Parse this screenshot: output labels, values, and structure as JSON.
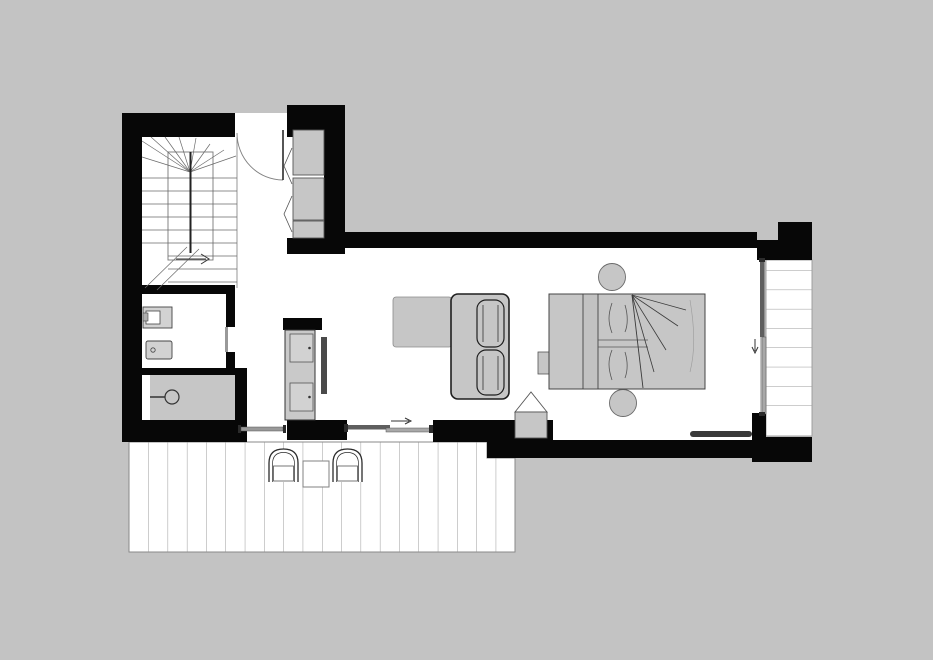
{
  "document": {
    "kind": "architectural floor plan",
    "description": "Monochrome apartment floor plan with black walls, winder staircase, bathroom, shower, kitchen unit, living area with L-shaped sofa, sleeping area with double bed, wooden deck with two chairs and side table, and a narrow side balcony",
    "visible_text": ""
  },
  "colors": {
    "bg": "#c3c3c3",
    "floor": "#ffffff",
    "wall": "#070707",
    "furn": "#c6c6c6",
    "furnlight": "#d2d2d2",
    "furndark": "#b8b8b8",
    "ink": "#2b2b2b",
    "mid": "#555555",
    "line": "#9a9a9a",
    "glass1": "#5f5f5f",
    "glass2": "#a8a8a8",
    "dark": "#3a3a3a"
  },
  "rooms": [
    {
      "name": "stair-hall"
    },
    {
      "name": "bathroom"
    },
    {
      "name": "shower-room"
    },
    {
      "name": "kitchenette"
    },
    {
      "name": "living-area"
    },
    {
      "name": "sleeping-area"
    },
    {
      "name": "deck"
    },
    {
      "name": "balcony"
    }
  ],
  "furniture": [
    {
      "name": "winder-staircase"
    },
    {
      "name": "entrance-door"
    },
    {
      "name": "wardrobe"
    },
    {
      "name": "washbasin"
    },
    {
      "name": "toilet"
    },
    {
      "name": "shower-head"
    },
    {
      "name": "kitchen-unit"
    },
    {
      "name": "l-shaped-sofa"
    },
    {
      "name": "double-bed"
    },
    {
      "name": "round-side-tables"
    },
    {
      "name": "stove"
    },
    {
      "name": "deck-chairs"
    },
    {
      "name": "deck-table"
    },
    {
      "name": "doormat"
    },
    {
      "name": "sliding-door-deck"
    },
    {
      "name": "sliding-door-balcony"
    },
    {
      "name": "bathroom-window"
    }
  ]
}
